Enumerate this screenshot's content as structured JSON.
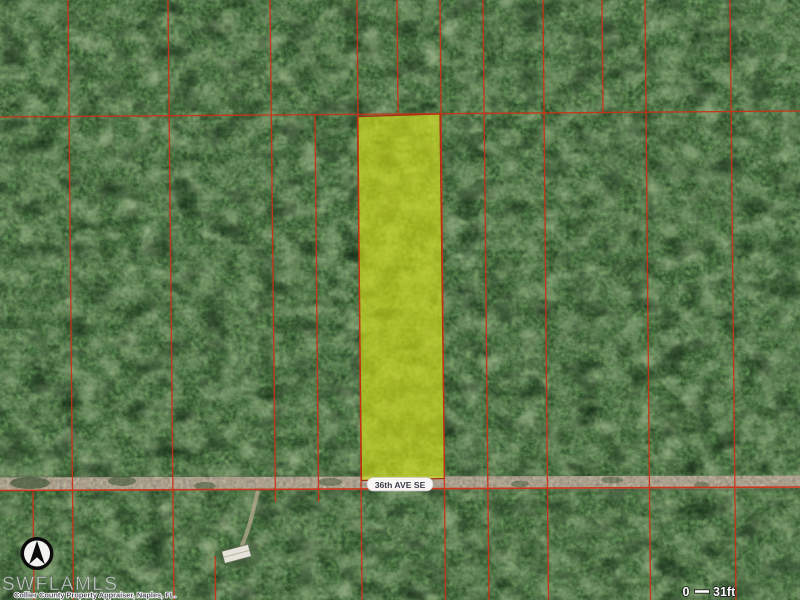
{
  "map": {
    "road_label": "36th AVE SE",
    "watermark": "SWFLAMLS",
    "attribution": "Collier County Property Appraiser, Naples, FL.",
    "scale_bar": {
      "start_label": "0",
      "end_label": "31ft"
    },
    "compass_icon": "north-arrow",
    "colors": {
      "parcel_boundary": "#cf2f14",
      "parcel_highlight": "#d8e416",
      "road_surface": "#c6baa4"
    }
  }
}
